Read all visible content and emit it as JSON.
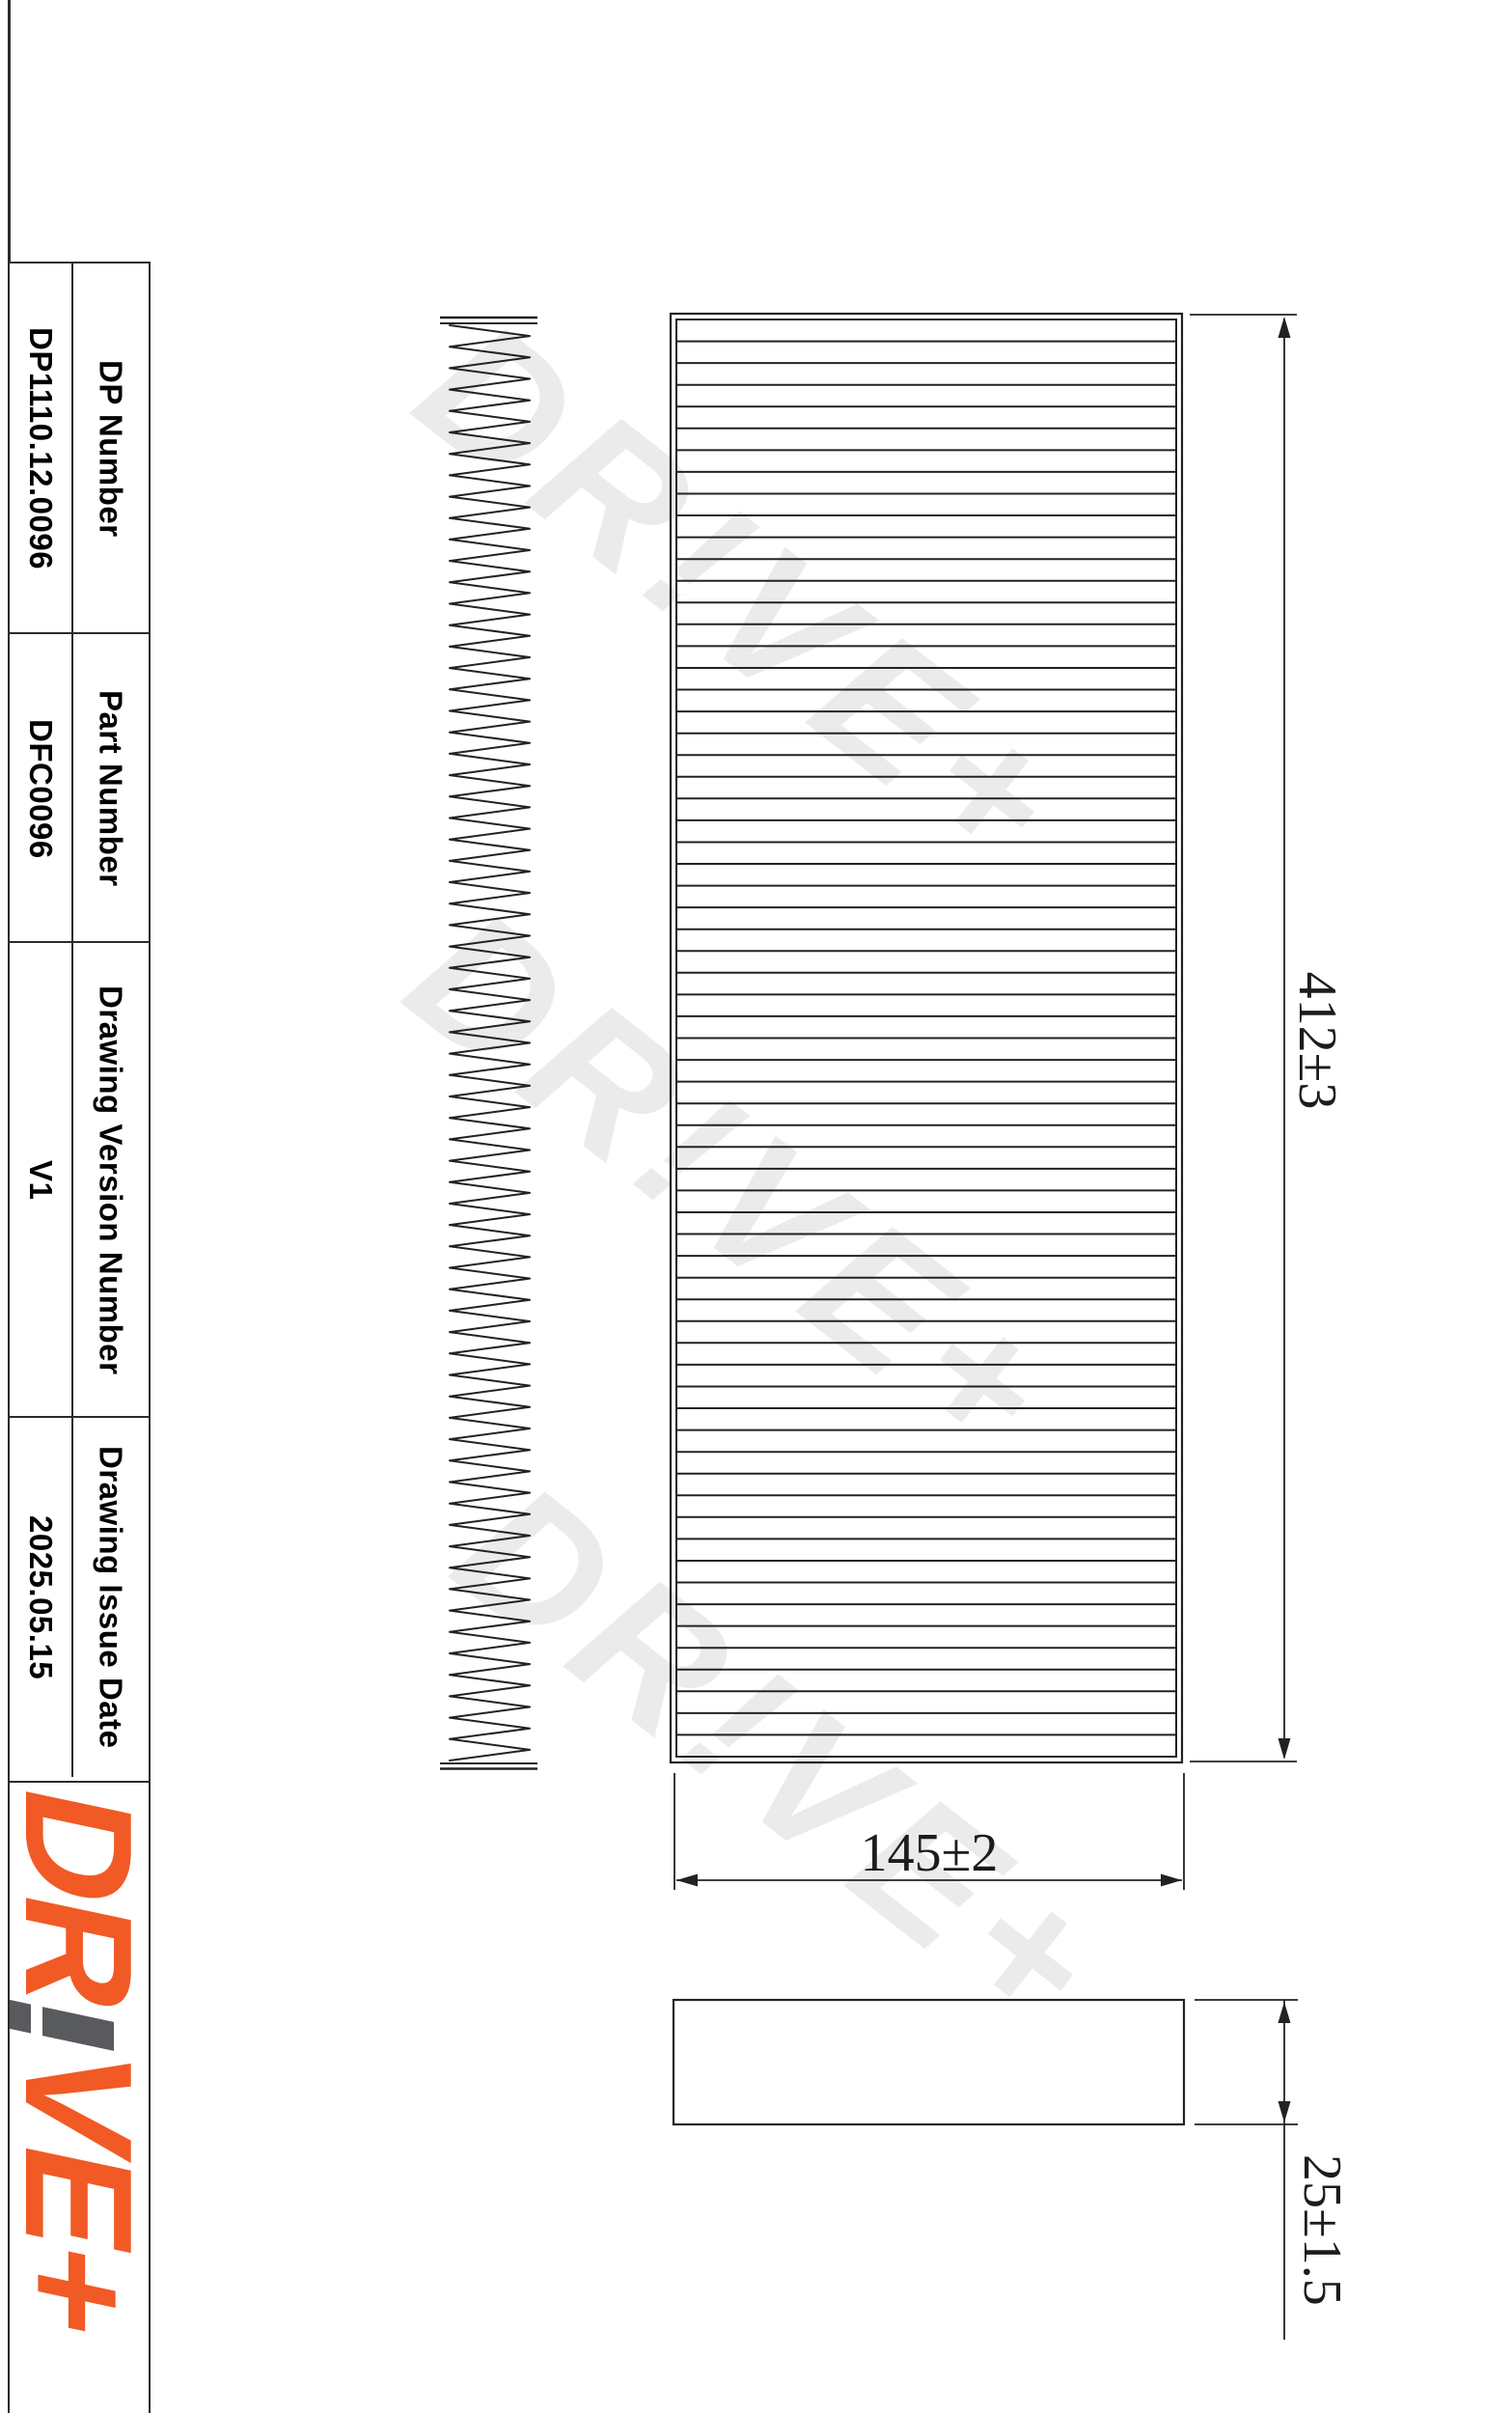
{
  "table": {
    "rows": [
      {
        "label": "DP Number",
        "value": "DP1110.12.0096"
      },
      {
        "label": "Part Number",
        "value": "DFC0096"
      },
      {
        "label": "Drawing Version Number",
        "value": "V1"
      },
      {
        "label": "Drawing Issue Date",
        "value": "2025.05.15"
      }
    ]
  },
  "logo": {
    "left": "DR",
    "right": "VE+",
    "orange": "#f15a24",
    "gray": "#595a5e"
  },
  "watermark": {
    "text": "DR!VE+",
    "color": "#ebebeb"
  },
  "drawing": {
    "dim_length": {
      "label": "412±3"
    },
    "dim_width": {
      "label": "145±2"
    },
    "dim_thickness": {
      "label": "25±1.5"
    },
    "pleat_line_count": 65,
    "zigzag_cycles": 67,
    "line_color": "#222222"
  }
}
